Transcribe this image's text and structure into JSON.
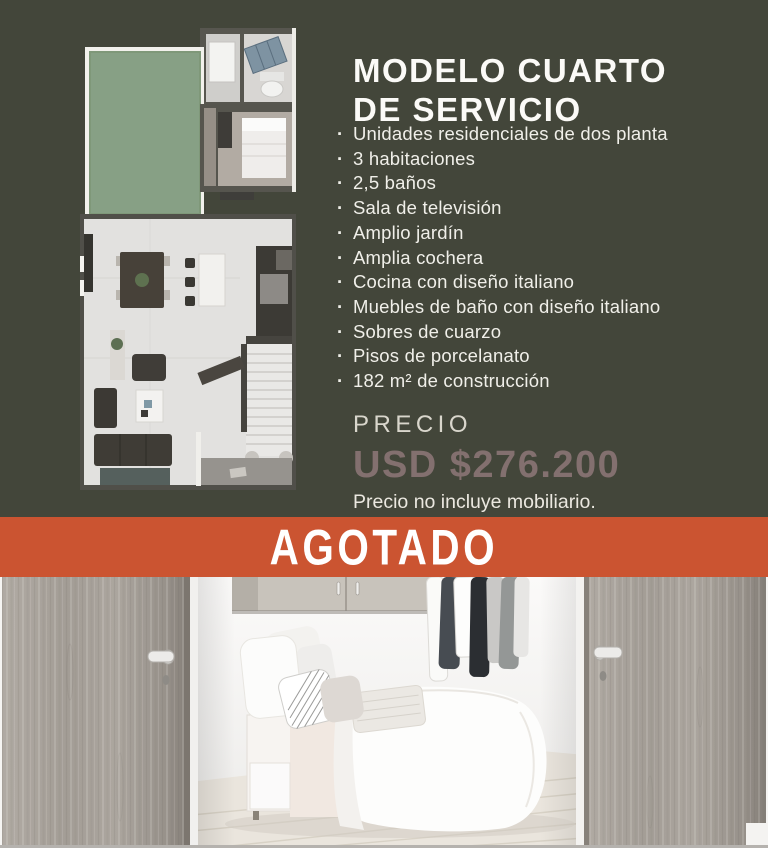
{
  "colors": {
    "background": "#43463a",
    "banner_bg": "#cb5431",
    "banner_text": "#ffffff",
    "title_text": "#fbfaf7",
    "list_text": "#f0efe9",
    "price_label_text": "#d9d6cc",
    "price_value_text": "#83706f",
    "price_note_text": "#ebe8e0"
  },
  "listing": {
    "title_line1": "MODELO CUARTO",
    "title_line2": "DE SERVICIO",
    "features": [
      "Unidades residenciales de dos planta",
      "3 habitaciones",
      "2,5 baños",
      "Sala de televisión",
      "Amplio jardín",
      "Amplia cochera",
      "Cocina con diseño italiano",
      "Muebles de baño con diseño italiano",
      "Sobres de cuarzo",
      "Pisos de porcelanato",
      "182 m² de construcción"
    ],
    "price": {
      "label": "PRECIO",
      "value": "USD $276.200",
      "note": "Precio no incluye mobiliario."
    },
    "status_banner": "AGOTADO"
  }
}
